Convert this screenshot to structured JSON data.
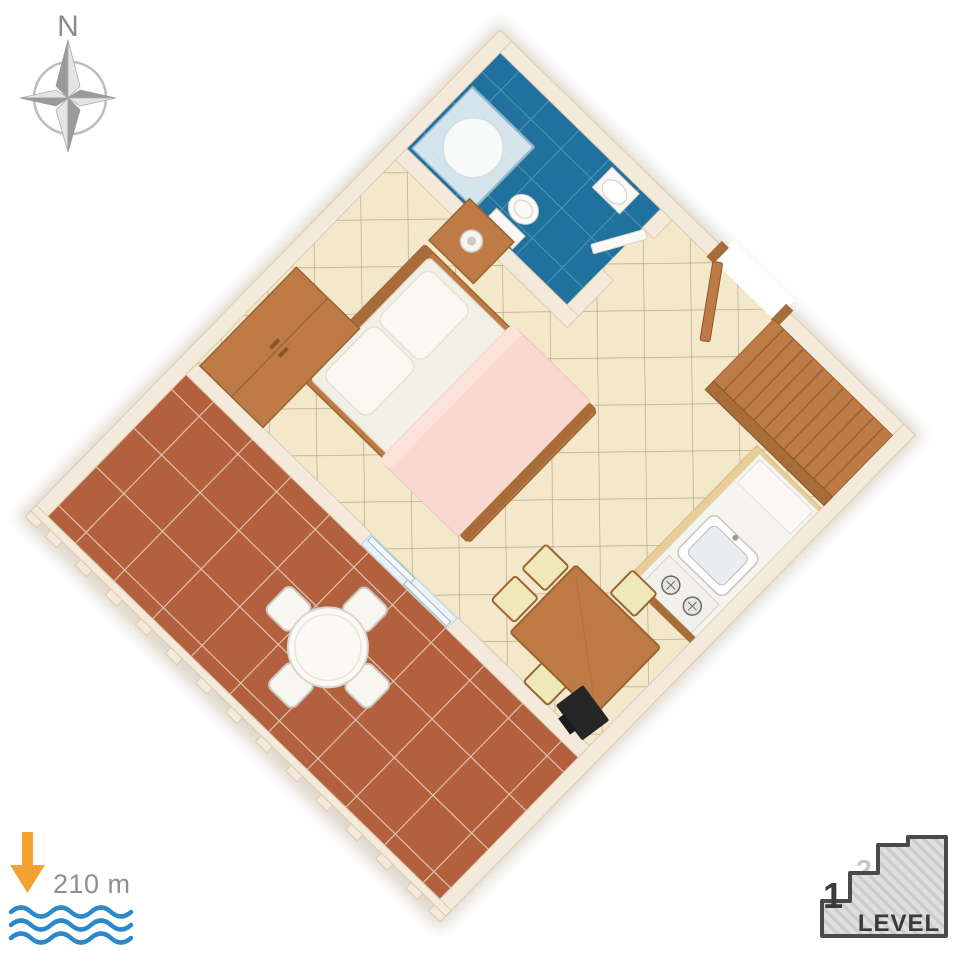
{
  "page": {
    "background": "#ffffff"
  },
  "compass": {
    "label": "N",
    "color": "#8C8C8C",
    "star_dark": "#9A9A9A",
    "star_light": "#E4E4E4",
    "ring_color": "#BDBDBD"
  },
  "sea_distance": {
    "value": "210 m",
    "text_color": "#8F8F8F",
    "arrow_color": "#F2A233",
    "wave_color": "#2B88CB"
  },
  "level_indicator": {
    "current_level": "1",
    "upper_level": "2",
    "label": "LEVEL",
    "border_color": "#4A4A4A",
    "fill_color": "#DFDFDF",
    "hatch_color": "#CBCBCB",
    "current_color": "#3A3A3A",
    "upper_color": "#C8C8C8"
  },
  "floor_plan": {
    "type": "apartment-3d-floor-plan",
    "rotation_deg": 44.3,
    "colors": {
      "wall": "#F3EADC",
      "wall_edge": "#DCC9AE",
      "floor_main": "#F3E8C9",
      "floor_grout": "#6F6455",
      "floor_terrace": "#B2603E",
      "terrace_grout": "#E8CDBB",
      "floor_bathroom": "#20719D",
      "bathroom_grout": "#5E9FC0",
      "wood": "#BE7B45",
      "wood_dark": "#A86C38",
      "wood_light": "#E9CD96",
      "bedding": "#F2EFE6",
      "pillow": "#FAF8F2",
      "blanket": "#F8D8CF",
      "fixture_white": "#F8F7F3",
      "glass": "#EAF2F5",
      "tv": "#262626",
      "shadow": "#B9A98F"
    },
    "rooms": [
      {
        "name": "bathroom"
      },
      {
        "name": "bedroom-living-area"
      },
      {
        "name": "kitchen-corner"
      },
      {
        "name": "terrace"
      }
    ],
    "furniture": [
      "shower-cabin",
      "toilet",
      "washbasin",
      "bathroom-door",
      "entrance-door",
      "staircase",
      "double-bed",
      "pillows",
      "blanket",
      "nightstand",
      "bedside-lamp",
      "wardrobe",
      "kitchen-counter",
      "fridge",
      "sink",
      "stove",
      "dining-table",
      "dining-chairs",
      "tv",
      "sliding-terrace-door",
      "terrace-round-table",
      "terrace-chairs",
      "terrace-railing"
    ]
  }
}
